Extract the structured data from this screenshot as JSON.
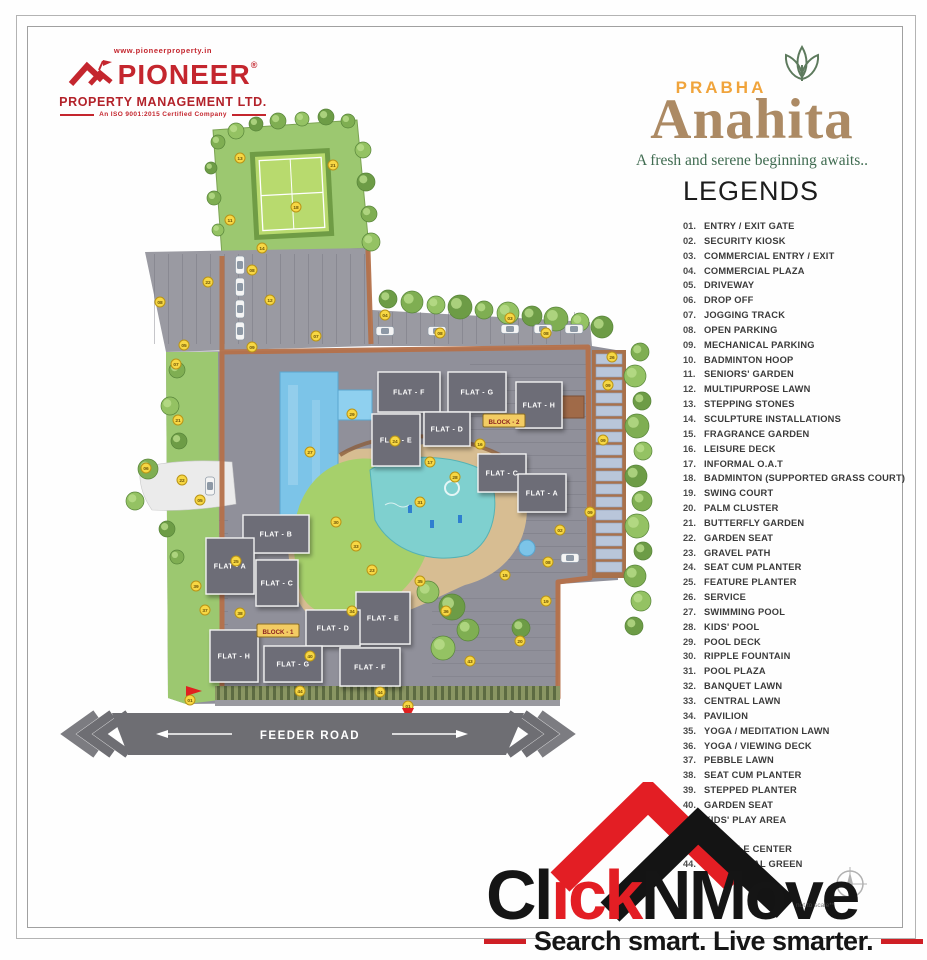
{
  "header": {
    "pioneer": {
      "website": "www.pioneerproperty.in",
      "name": "PIONEER",
      "registered": "®",
      "line2": "PROPERTY MANAGEMENT LTD.",
      "certification": "An ISO 9001:2015 Certified Company",
      "brand_color": "#c4262e"
    },
    "project": {
      "brand": "PRABHA",
      "name": "Anahita",
      "tagline": "A fresh and serene beginning awaits..",
      "brand_color": "#f0a43c",
      "name_color": "#ac8a64",
      "tagline_color": "#3f6b50"
    }
  },
  "legends": {
    "title": "LEGENDS",
    "items": [
      {
        "no": "01.",
        "label": "ENTRY / EXIT GATE"
      },
      {
        "no": "02.",
        "label": "SECURITY KIOSK"
      },
      {
        "no": "03.",
        "label": "COMMERCIAL ENTRY / EXIT"
      },
      {
        "no": "04.",
        "label": "COMMERCIAL PLAZA"
      },
      {
        "no": "05.",
        "label": "DRIVEWAY"
      },
      {
        "no": "06.",
        "label": "DROP OFF"
      },
      {
        "no": "07.",
        "label": "JOGGING TRACK"
      },
      {
        "no": "08.",
        "label": "OPEN PARKING"
      },
      {
        "no": "09.",
        "label": "MECHANICAL PARKING"
      },
      {
        "no": "10.",
        "label": "BADMINTON HOOP"
      },
      {
        "no": "11.",
        "label": "SENIORS' GARDEN"
      },
      {
        "no": "12.",
        "label": "MULTIPURPOSE LAWN"
      },
      {
        "no": "13.",
        "label": "STEPPING STONES"
      },
      {
        "no": "14.",
        "label": "SCULPTURE INSTALLATIONS"
      },
      {
        "no": "15.",
        "label": "FRAGRANCE GARDEN"
      },
      {
        "no": "16.",
        "label": "LEISURE DECK"
      },
      {
        "no": "17.",
        "label": "INFORMAL O.A.T"
      },
      {
        "no": "18.",
        "label": "BADMINTON (SUPPORTED GRASS COURT)"
      },
      {
        "no": "19.",
        "label": "SWING COURT"
      },
      {
        "no": "20.",
        "label": "PALM CLUSTER"
      },
      {
        "no": "21.",
        "label": "BUTTERFLY GARDEN"
      },
      {
        "no": "22.",
        "label": "GARDEN SEAT"
      },
      {
        "no": "23.",
        "label": "GRAVEL PATH"
      },
      {
        "no": "24.",
        "label": "SEAT CUM PLANTER"
      },
      {
        "no": "25.",
        "label": "FEATURE PLANTER"
      },
      {
        "no": "26.",
        "label": "SERVICE"
      },
      {
        "no": "27.",
        "label": "SWIMMING POOL"
      },
      {
        "no": "28.",
        "label": "KIDS' POOL"
      },
      {
        "no": "29.",
        "label": "POOL DECK"
      },
      {
        "no": "30.",
        "label": "RIPPLE FOUNTAIN"
      },
      {
        "no": "31.",
        "label": "POOL PLAZA"
      },
      {
        "no": "32.",
        "label": "BANQUET LAWN"
      },
      {
        "no": "33.",
        "label": "CENTRAL LAWN"
      },
      {
        "no": "34.",
        "label": "PAVILION"
      },
      {
        "no": "35.",
        "label": "YOGA / MEDITATION LAWN"
      },
      {
        "no": "36.",
        "label": "YOGA / VIEWING DECK"
      },
      {
        "no": "37.",
        "label": "PEBBLE LAWN"
      },
      {
        "no": "38.",
        "label": "SEAT CUM PLANTER"
      },
      {
        "no": "39.",
        "label": "STEPPED PLANTER"
      },
      {
        "no": "40.",
        "label": "GARDEN SEAT"
      },
      {
        "no": "41.",
        "label": "KIDS' PLAY AREA"
      },
      {
        "no": "42.",
        "label": ""
      },
      {
        "no": "43.",
        "label": "RECYCLE CENTER"
      },
      {
        "no": "44.",
        "label": "PERIPHERAL GREEN"
      }
    ]
  },
  "map": {
    "road_label": "FEEDER ROAD",
    "marker_color": "#f7d744",
    "block_tags": [
      {
        "label": "BLOCK - 2",
        "x": 504,
        "y": 421
      },
      {
        "label": "BLOCK - 1",
        "x": 278,
        "y": 631
      }
    ],
    "flats": [
      {
        "label": "FLAT - F",
        "x": 378,
        "y": 372,
        "w": 62,
        "h": 40
      },
      {
        "label": "FLAT - G",
        "x": 448,
        "y": 372,
        "w": 58,
        "h": 40
      },
      {
        "label": "FLAT - H",
        "x": 516,
        "y": 382,
        "w": 46,
        "h": 46
      },
      {
        "label": "FLAT - E",
        "x": 372,
        "y": 414,
        "w": 48,
        "h": 52
      },
      {
        "label": "FLAT - D",
        "x": 424,
        "y": 412,
        "w": 46,
        "h": 34
      },
      {
        "label": "FLAT - C",
        "x": 478,
        "y": 454,
        "w": 48,
        "h": 38
      },
      {
        "label": "FLAT - A",
        "x": 518,
        "y": 474,
        "w": 48,
        "h": 38
      },
      {
        "label": "FLAT - B",
        "x": 243,
        "y": 515,
        "w": 66,
        "h": 38
      },
      {
        "label": "FLAT - A",
        "x": 206,
        "y": 538,
        "w": 48,
        "h": 56
      },
      {
        "label": "FLAT - C",
        "x": 256,
        "y": 560,
        "w": 42,
        "h": 46
      },
      {
        "label": "FLAT - E",
        "x": 356,
        "y": 592,
        "w": 54,
        "h": 52
      },
      {
        "label": "FLAT - D",
        "x": 306,
        "y": 610,
        "w": 54,
        "h": 36
      },
      {
        "label": "FLAT - H",
        "x": 210,
        "y": 630,
        "w": 48,
        "h": 52
      },
      {
        "label": "FLAT - G",
        "x": 264,
        "y": 646,
        "w": 58,
        "h": 36
      },
      {
        "label": "FLAT - F",
        "x": 340,
        "y": 648,
        "w": 60,
        "h": 38
      }
    ],
    "markers": [
      {
        "x": 240,
        "y": 158,
        "n": "13"
      },
      {
        "x": 296,
        "y": 207,
        "n": "18"
      },
      {
        "x": 333,
        "y": 165,
        "n": "21"
      },
      {
        "x": 230,
        "y": 220,
        "n": "11"
      },
      {
        "x": 262,
        "y": 248,
        "n": "14"
      },
      {
        "x": 270,
        "y": 300,
        "n": "12"
      },
      {
        "x": 316,
        "y": 336,
        "n": "07"
      },
      {
        "x": 208,
        "y": 282,
        "n": "22"
      },
      {
        "x": 252,
        "y": 270,
        "n": "08"
      },
      {
        "x": 160,
        "y": 302,
        "n": "08"
      },
      {
        "x": 184,
        "y": 345,
        "n": "05"
      },
      {
        "x": 252,
        "y": 347,
        "n": "09"
      },
      {
        "x": 440,
        "y": 333,
        "n": "08"
      },
      {
        "x": 546,
        "y": 333,
        "n": "08"
      },
      {
        "x": 510,
        "y": 318,
        "n": "03"
      },
      {
        "x": 385,
        "y": 315,
        "n": "04"
      },
      {
        "x": 608,
        "y": 385,
        "n": "09"
      },
      {
        "x": 603,
        "y": 440,
        "n": "09"
      },
      {
        "x": 590,
        "y": 512,
        "n": "09"
      },
      {
        "x": 548,
        "y": 562,
        "n": "08"
      },
      {
        "x": 612,
        "y": 357,
        "n": "26"
      },
      {
        "x": 310,
        "y": 452,
        "n": "27"
      },
      {
        "x": 352,
        "y": 414,
        "n": "29"
      },
      {
        "x": 455,
        "y": 477,
        "n": "28"
      },
      {
        "x": 420,
        "y": 502,
        "n": "31"
      },
      {
        "x": 356,
        "y": 546,
        "n": "33"
      },
      {
        "x": 336,
        "y": 522,
        "n": "30"
      },
      {
        "x": 395,
        "y": 441,
        "n": "24"
      },
      {
        "x": 480,
        "y": 444,
        "n": "16"
      },
      {
        "x": 430,
        "y": 462,
        "n": "17"
      },
      {
        "x": 176,
        "y": 364,
        "n": "07"
      },
      {
        "x": 178,
        "y": 420,
        "n": "21"
      },
      {
        "x": 182,
        "y": 480,
        "n": "22"
      },
      {
        "x": 146,
        "y": 468,
        "n": "06"
      },
      {
        "x": 200,
        "y": 500,
        "n": "05"
      },
      {
        "x": 205,
        "y": 610,
        "n": "37"
      },
      {
        "x": 240,
        "y": 613,
        "n": "38"
      },
      {
        "x": 310,
        "y": 656,
        "n": "40"
      },
      {
        "x": 352,
        "y": 611,
        "n": "34"
      },
      {
        "x": 420,
        "y": 581,
        "n": "35"
      },
      {
        "x": 446,
        "y": 611,
        "n": "36"
      },
      {
        "x": 300,
        "y": 691,
        "n": "44"
      },
      {
        "x": 380,
        "y": 692,
        "n": "44"
      },
      {
        "x": 470,
        "y": 661,
        "n": "43"
      },
      {
        "x": 520,
        "y": 641,
        "n": "20"
      },
      {
        "x": 546,
        "y": 601,
        "n": "19"
      },
      {
        "x": 196,
        "y": 586,
        "n": "39"
      },
      {
        "x": 236,
        "y": 561,
        "n": "25"
      },
      {
        "x": 190,
        "y": 700,
        "n": "01"
      },
      {
        "x": 408,
        "y": 706,
        "n": "01"
      },
      {
        "x": 372,
        "y": 570,
        "n": "23"
      },
      {
        "x": 505,
        "y": 575,
        "n": "15"
      },
      {
        "x": 560,
        "y": 530,
        "n": "02"
      }
    ]
  },
  "watermark": {
    "text_black1": "Cl",
    "text_red": "ick",
    "text_black2": "NMove",
    "tagline": "Search smart. Live smarter.",
    "scale_note": "not to scale**",
    "red": "#e31e24"
  }
}
